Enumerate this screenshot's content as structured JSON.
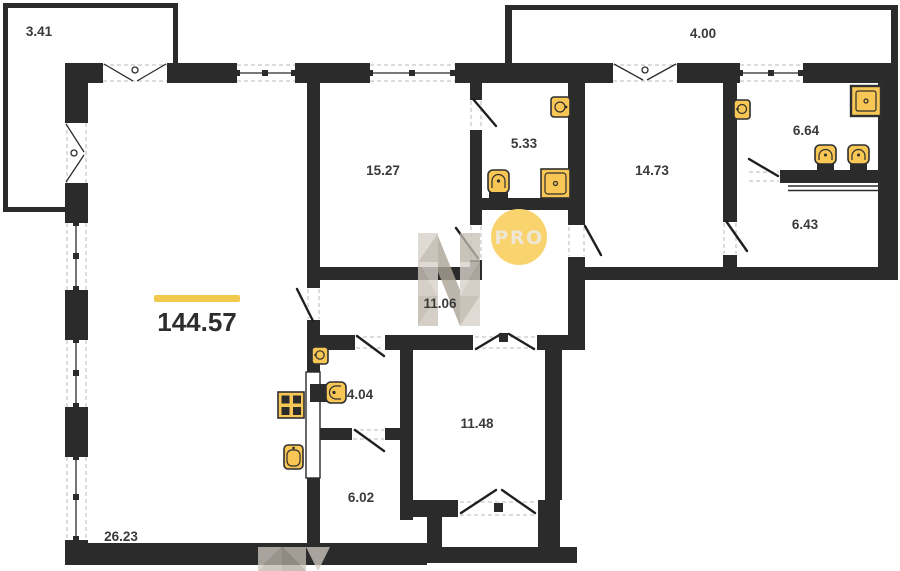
{
  "plan": {
    "total_area": {
      "value": "144.57"
    },
    "watermark": {
      "badge": "PRO",
      "logo_letter": "N"
    },
    "rooms": {
      "balcony_small": "3.41",
      "balcony_large": "4.00",
      "bedroom_1": "15.27",
      "bathroom_1": "5.33",
      "bedroom_2": "14.73",
      "bathroom_2": "6.64",
      "dressing": "6.43",
      "hallway": "11.06",
      "wc": "4.04",
      "entry_hall": "11.48",
      "bathroom_3": "6.02",
      "living_kitchen": "26.23"
    },
    "fixture_icons": [
      "sink-icon",
      "toilet-icon",
      "shower-icon",
      "stove-icon"
    ],
    "colors": {
      "wall": "#2b2b2b",
      "fixture_fill": "#f7c654",
      "accent_bar": "#f2c94c",
      "badge_fill": "#f8d36e",
      "badge_text": "#eee7d5",
      "watermark_gray": "#c3bcb2"
    }
  }
}
